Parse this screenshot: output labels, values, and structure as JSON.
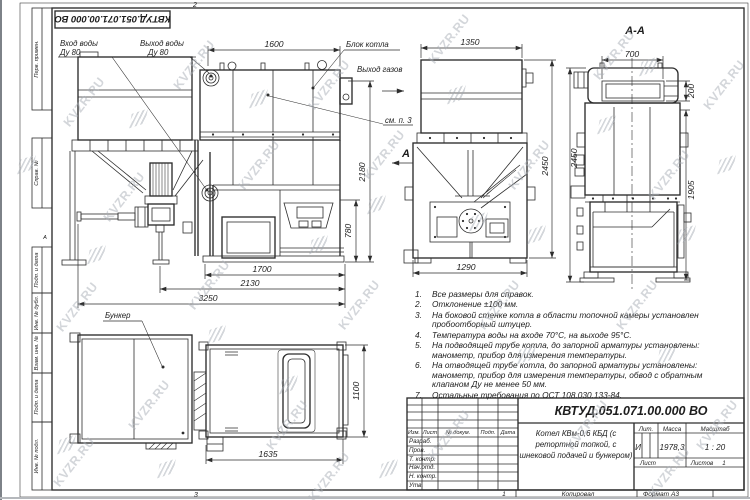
{
  "watermark": {
    "text": "KVZR.RU"
  },
  "sheet": {
    "top_stamp": "КВТУД.051.071.00.000 ВО",
    "zone_top": "2",
    "zone_bottom": "3",
    "zone_footer_left": "1",
    "fold_mark": "А",
    "left_stamps": [
      "Перв. примен.",
      "Справ. №",
      "Подп. и дата",
      "Инв. № дубл.",
      "Взам. инв. №",
      "Подп. и дата",
      "Инв. № подл."
    ],
    "footer": {
      "copied": "Копировал",
      "format": "Формат А3"
    }
  },
  "callouts": {
    "water_in_1": "Вход воды",
    "water_in_2": "Ду 80",
    "water_out_1": "Выход воды",
    "water_out_2": "Ду 80",
    "boiler_block": "Блок котла",
    "gas_out": "Выход газов",
    "see_note": "см. п. 3",
    "bunker": "Бункер",
    "view_arrow": "А",
    "section_title": "А-А"
  },
  "dims": {
    "front_top": "1600",
    "front_height": "2180",
    "front_ash": "780",
    "front_b1": "1700",
    "front_b2": "2130",
    "front_b3": "3250",
    "side_top": "1350",
    "side_height": "2450",
    "side_bottom": "1290",
    "sec_top": "700",
    "sec_window": "200",
    "sec_body": "1905",
    "sec_height": "2450",
    "plan_bottom": "1635",
    "plan_side": "1100"
  },
  "notes": {
    "items": [
      {
        "num": "1.",
        "text": "Все размеры для справок."
      },
      {
        "num": "2.",
        "text": "Отклонение ±100 мм."
      },
      {
        "num": "3.",
        "text": "На боковой стенке котла в области топочной камеры установлен пробоотборный штуцер."
      },
      {
        "num": "4.",
        "text": "Температура воды на входе 70°С, на выходе 95°С."
      },
      {
        "num": "5.",
        "text": "На подводящей трубе котла, до запорной арматуры установлены: манометр, прибор для измерения температуры."
      },
      {
        "num": "6.",
        "text": "На отводящей трубе котла, до запорной арматуры установлены: манометр, прибор для измерения температуры, обвод с обратным клапаном Ду не менее 50 мм."
      },
      {
        "num": "7.",
        "text": "Остальные требования по ОСТ 108.030.133-84."
      }
    ]
  },
  "title_block": {
    "designation": "КВТУД.051.071.00.000 ВО",
    "name_line1": "Котел КВм-0,6 КБД (с",
    "name_line2": "ретортной топкой, с",
    "name_line3": "шнековой подачей и бункером)",
    "col_izm": "Изм.",
    "col_list": "Лист",
    "col_doc": "№ докум.",
    "col_podp": "Подп.",
    "col_data": "Дата",
    "rows": [
      "Разраб.",
      "Пров.",
      "Т. контр.",
      "Нач.отд.",
      "Н. контр.",
      "Утв."
    ],
    "lit_label": "Лит.",
    "lit_value": "И",
    "mass_label": "Масса",
    "mass_value": "1978,3",
    "scale_label": "Масштаб",
    "scale_value": "1 : 20",
    "sheet_label": "Лист",
    "sheets_label": "Листов",
    "sheets_value": "1"
  }
}
